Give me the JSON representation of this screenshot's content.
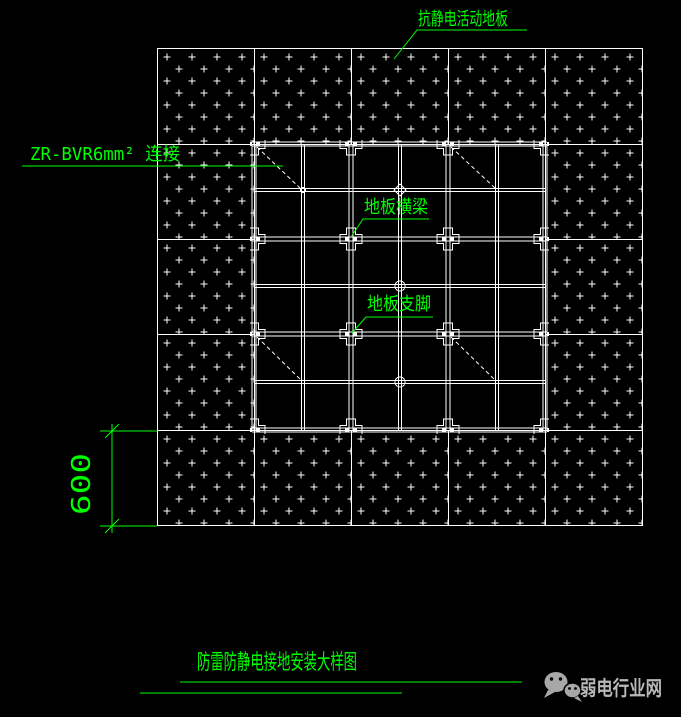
{
  "page": {
    "background": "#000000"
  },
  "drawing": {
    "annotation_color": "#00ff00",
    "line_color": "#ffffff",
    "labels": {
      "floor_panel": "抗静电活动地板",
      "ground_wire": "ZR-BVR6mm² 连接",
      "floor_beam": "地板横梁",
      "floor_support": "地板支脚"
    },
    "dimension": "600",
    "title": "防雷防静电接地安装大样图"
  },
  "footer": {
    "wechat_icon": "wechat-icon",
    "brand": "弱电行业网",
    "brand_color": "#b8b8b8"
  }
}
